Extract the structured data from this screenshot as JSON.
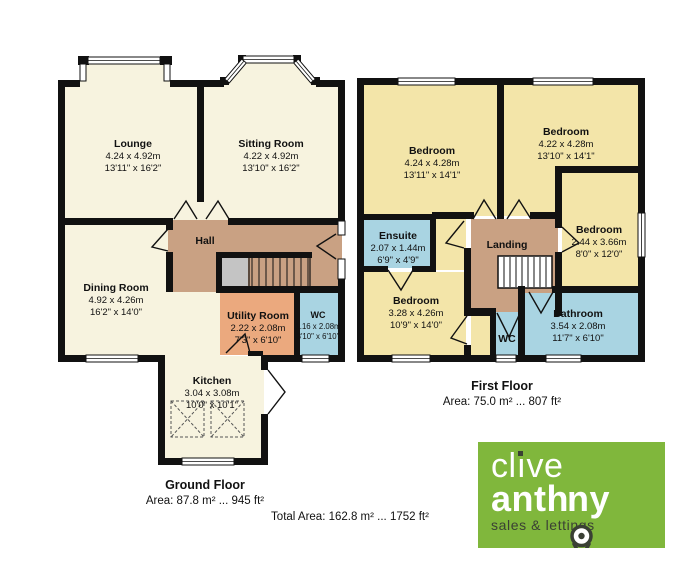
{
  "ground": {
    "title": "Ground Floor",
    "area": "Area: 87.8 m² ... 945 ft²",
    "lounge": {
      "name": "Lounge",
      "m": "4.24 x 4.92m",
      "i": "13'11\" x 16'2\""
    },
    "sitting": {
      "name": "Sitting Room",
      "m": "4.22 x 4.92m",
      "i": "13'10\" x 16'2\""
    },
    "hall": {
      "name": "Hall"
    },
    "dining": {
      "name": "Dining Room",
      "m": "4.92 x 4.26m",
      "i": "16'2\" x 14'0\""
    },
    "utility": {
      "name": "Utility Room",
      "m": "2.22 x 2.08m",
      "i": "7'3\" x 6'10\""
    },
    "wc": {
      "name": "WC",
      "m": "1.16 x 2.08m",
      "i": "3'10\" x 6'10\""
    },
    "kitchen": {
      "name": "Kitchen",
      "m": "3.04 x 3.08m",
      "i": "10'0\" x 10'1\""
    }
  },
  "first": {
    "title": "First Floor",
    "area": "Area: 75.0 m² ... 807 ft²",
    "bedroom1": {
      "name": "Bedroom",
      "m": "4.24 x 4.28m",
      "i": "13'11\" x 14'1\""
    },
    "bedroom2": {
      "name": "Bedroom",
      "m": "4.22 x 4.28m",
      "i": "13'10\" x 14'1\""
    },
    "bedroom3": {
      "name": "Bedroom",
      "m": "2.44 x 3.66m",
      "i": "8'0\" x 12'0\""
    },
    "bedroom4": {
      "name": "Bedroom",
      "m": "3.28 x 4.26m",
      "i": "10'9\" x 14'0\""
    },
    "ensuite": {
      "name": "Ensuite",
      "m": "2.07 x 1.44m",
      "i": "6'9\" x 4'9\""
    },
    "landing": {
      "name": "Landing"
    },
    "wc": {
      "name": "WC"
    },
    "bathroom": {
      "name": "Bathroom",
      "m": "3.54 x 2.08m",
      "i": "11'7\" x 6'10\""
    }
  },
  "total_area": "Total Area: 162.8 m² ... 1752 ft²",
  "logo": {
    "brand_pre": "cl",
    "brand_i": "ı",
    "brand_post": "ve",
    "brand2_pre": "anth",
    "brand2_post": "ny",
    "tagline": "sales & lettings"
  },
  "colors": {
    "wall": "#111111",
    "room_cream": "#F7F3DF",
    "room_yellow": "#F3E5A9",
    "hall_tan": "#C9A183",
    "utility_orange": "#EBA97E",
    "bath_blue": "#A9D4E2",
    "vestibule_gray": "#C4C4C4",
    "logo_green": "#80B73C",
    "logo_dark": "#3A4034"
  }
}
